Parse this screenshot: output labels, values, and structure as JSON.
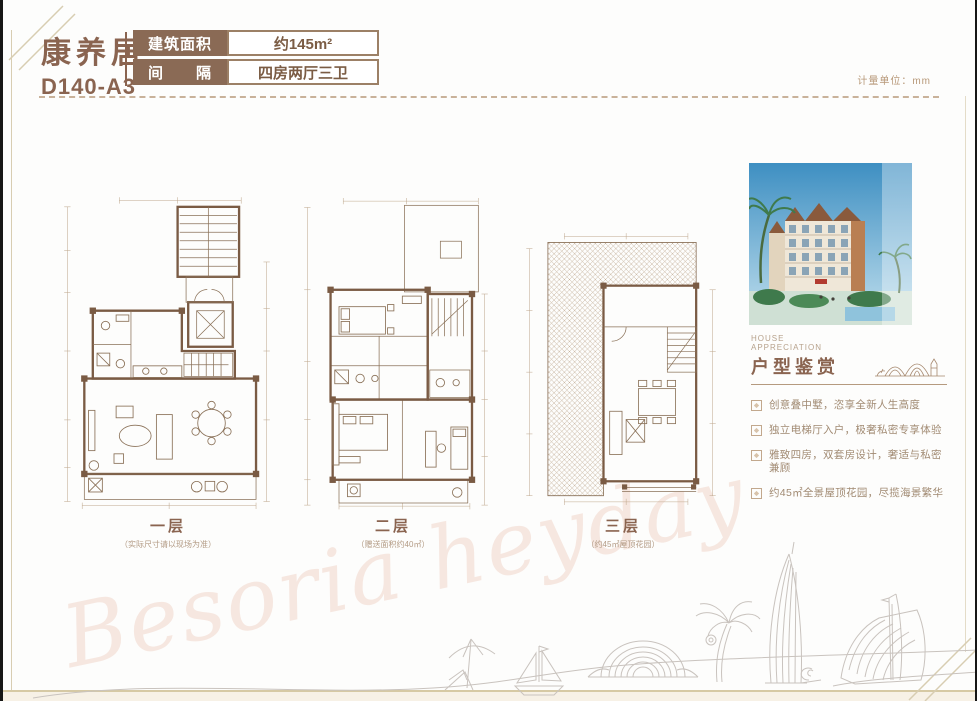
{
  "page": {
    "unit_note": "计量单位：mm",
    "watermark": "Besoria heyday"
  },
  "header": {
    "project_name": "康养居",
    "unit_code": "D140-A3",
    "specs": [
      {
        "label": "建筑面积",
        "value": "约145m²"
      },
      {
        "label": "间　　隔",
        "value": "四房两厅三卫"
      }
    ]
  },
  "floors": [
    {
      "label": "一层",
      "note": "（实际尺寸请以现场为准）"
    },
    {
      "label": "二层",
      "note": "（赠送面积约40㎡）"
    },
    {
      "label": "三层",
      "note": "（约45㎡屋顶花园）"
    }
  ],
  "appreciation": {
    "title_en_1": "HOUSE",
    "title_en_2": "APPRECIATION",
    "title_cn": "户型鉴赏",
    "points": [
      "创意叠中墅，恣享全新人生高度",
      "独立电梯厅入户，极奢私密专享体验",
      "雅致四房，双套房设计，奢适与私密兼顾",
      "约45㎡全景屋顶花园，尽揽海景繁华"
    ]
  },
  "colors": {
    "brand_brown": "#8a6450",
    "plan_line_brown": "#8a7158",
    "sky_blue": "#3e8fc2",
    "frame_gold": "#d6c9a4"
  }
}
